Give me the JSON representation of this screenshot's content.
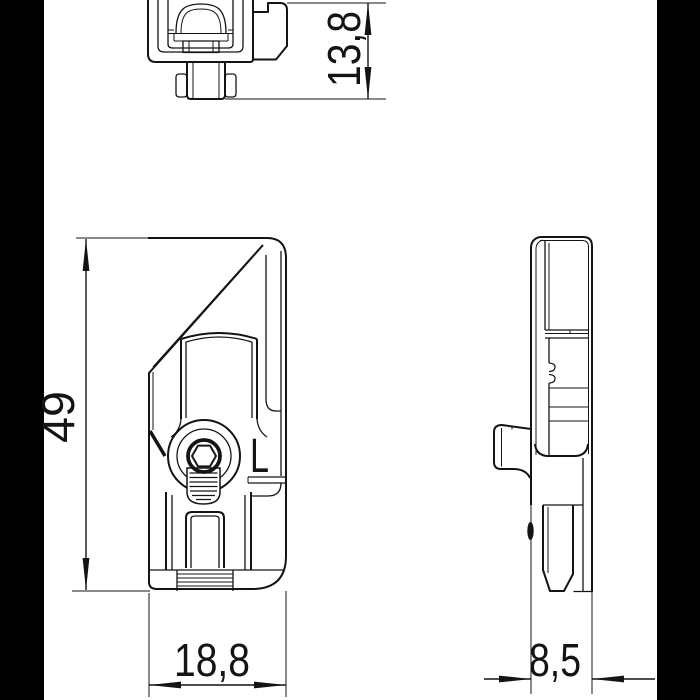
{
  "drawing": {
    "kind": "technical-drawing",
    "dimensions": {
      "depth": "13,8",
      "height": "49",
      "width": "18,8",
      "side_width": "8,5"
    },
    "marking": "L",
    "colors": {
      "line": "#141414",
      "background": "#ffffff",
      "side_bars": "#000000"
    }
  }
}
